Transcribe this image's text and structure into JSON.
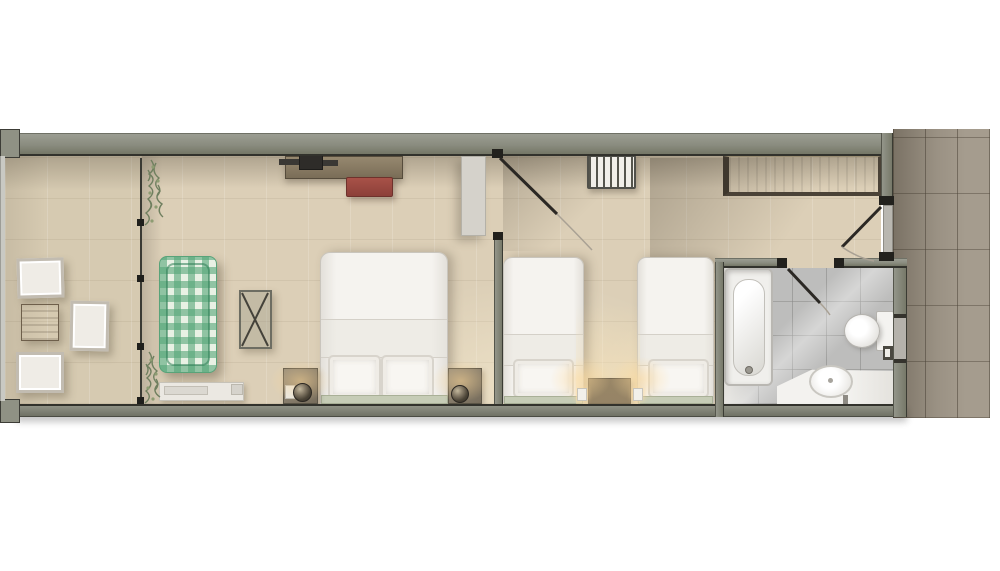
{
  "scene": {
    "kind": "apartment-hotel-suite-floor-plan",
    "view": "top-down-render",
    "background": "#ffffff",
    "visible_text": "none"
  },
  "palette": {
    "wall": "#878a7c",
    "wall_edge": "#32322c",
    "floor_tile": "#dccfb7",
    "balcony_floor": "#d6cab1",
    "bathroom_tile": "#bdbdbc",
    "corridor_tile": "#a59c8e",
    "linen_white": "#f3f1ed",
    "headboard_sage": "#c6ccb6",
    "daybed_green": "#58a379",
    "bench_red": "#9c4a41",
    "desk_wood": "#8b7d66",
    "wardrobe_wood": "#7c6f58",
    "nightstand_wood": "#867b6b",
    "lamp_glow": "#ffd696",
    "door_line": "#2b2824",
    "plant_green": "#6f7f5f"
  },
  "zones": [
    {
      "name": "balcony",
      "items": [
        "armchair",
        "armchair",
        "armchair",
        "wood-side-table",
        "railing",
        "planter-top",
        "planter-bottom",
        "sliding-glass-partition"
      ]
    },
    {
      "name": "living-bedroom",
      "items": [
        "media-console",
        "tv-soundbar",
        "red-bench",
        "green-gingham-daybed",
        "luggage-rack",
        "double-bed",
        "pillow",
        "pillow",
        "headboard",
        "nightstand-left",
        "nightstand-right",
        "table-lamp",
        "table-lamp",
        "light-switch",
        "ac-fan-coil-unit",
        "tall-closet",
        "interior-door"
      ]
    },
    {
      "name": "twin-bedroom",
      "items": [
        "radiator",
        "twin-bed",
        "twin-bed",
        "pillow",
        "pillow",
        "headboard",
        "headboard",
        "shared-nightstand",
        "small-lamp",
        "small-lamp"
      ]
    },
    {
      "name": "entry-hall",
      "items": [
        "wardrobe",
        "entry-door"
      ]
    },
    {
      "name": "bathroom",
      "items": [
        "bathtub",
        "tub-faucet",
        "toilet",
        "toilet-paper-holder",
        "vanity-counter",
        "sink-basin",
        "sink-faucet",
        "bathroom-door",
        "wall-niche"
      ]
    },
    {
      "name": "exterior-corridor",
      "items": [
        "stone-tile-paving"
      ]
    }
  ]
}
